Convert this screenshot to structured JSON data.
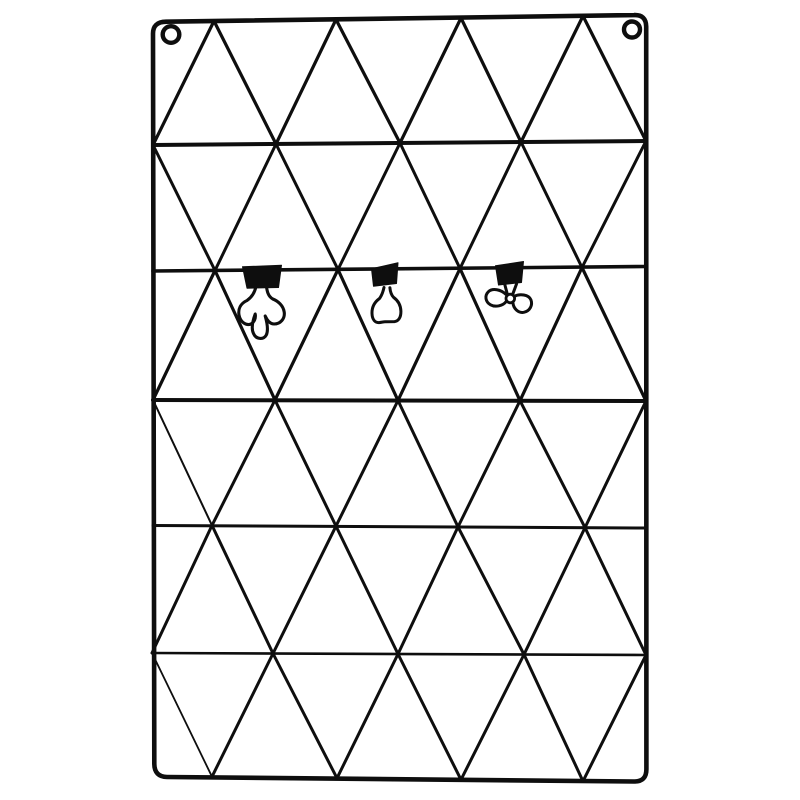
{
  "scene": {
    "description": "Black metal wire wall-mounted memo grid with triangular lattice, two hanging eyelets and three binder clips",
    "background_color": "#ffffff",
    "wire_color": "#0e0e0e"
  },
  "board": {
    "frame": {
      "path": "M 166 21.7 L 634 15.1 Q 646 14.5 646.2 26.5 L 646.4 769 Q 646.5 781.8 634 781.5 L 167 777 Q 154.5 776.8 154.3 764 L 153 34 Q 152.8 21.9 166 21.7 Z",
      "stroke_width": 4.6
    },
    "eyelets": [
      {
        "name": "hanging-eyelet-left",
        "cx": 171,
        "cy": 34.5,
        "r": 8.3,
        "stroke_width": 4.4
      },
      {
        "name": "hanging-eyelet-right",
        "cx": 632,
        "cy": 29.5,
        "r": 8.0,
        "stroke_width": 4.4
      }
    ],
    "horizontal_wires": [
      [
        153,
        145,
        646,
        141,
        4.0
      ],
      [
        153,
        271,
        646,
        266.5,
        3.6
      ],
      [
        153,
        400,
        646,
        401,
        4.0
      ],
      [
        153,
        525.5,
        646,
        528,
        3.0
      ],
      [
        152,
        653,
        646,
        655,
        2.6
      ]
    ],
    "diagonal_wires": [
      [
        153,
        145,
        214,
        21,
        3.2
      ],
      [
        214,
        21,
        276,
        144,
        3.2
      ],
      [
        276,
        144,
        336,
        19.5,
        3.2
      ],
      [
        336,
        19.5,
        400,
        143,
        3.2
      ],
      [
        400,
        143,
        461,
        18,
        3.2
      ],
      [
        461,
        18,
        521,
        142,
        3.2
      ],
      [
        521,
        142,
        583,
        16,
        3.2
      ],
      [
        583,
        16,
        646,
        141,
        3.2
      ],
      [
        153,
        145,
        215,
        270.5,
        3.0
      ],
      [
        215,
        270.5,
        276,
        144,
        3.0
      ],
      [
        276,
        144,
        338,
        269.5,
        3.0
      ],
      [
        338,
        269.5,
        400,
        143,
        3.0
      ],
      [
        400,
        143,
        460,
        268.5,
        3.0
      ],
      [
        460,
        268.5,
        521,
        142,
        3.0
      ],
      [
        521,
        142,
        582,
        267.5,
        3.0
      ],
      [
        582,
        267.5,
        646,
        141,
        3.0
      ],
      [
        153,
        400,
        215,
        270.5,
        3.2
      ],
      [
        215,
        270.5,
        275,
        400,
        3.2
      ],
      [
        275,
        400,
        338,
        269.5,
        3.2
      ],
      [
        338,
        269.5,
        398,
        400.5,
        3.2
      ],
      [
        398,
        400.5,
        460,
        268.5,
        3.2
      ],
      [
        460,
        268.5,
        520,
        400.7,
        3.2
      ],
      [
        520,
        400.7,
        582,
        267.5,
        3.2
      ],
      [
        582,
        267.5,
        646,
        401,
        3.2
      ],
      [
        153,
        400,
        212,
        525.4,
        2.0
      ],
      [
        212,
        525.4,
        275,
        400,
        3.0
      ],
      [
        275,
        400,
        336,
        526.1,
        3.0
      ],
      [
        336,
        526.1,
        398,
        400.5,
        3.0
      ],
      [
        398,
        400.5,
        458,
        526.9,
        3.0
      ],
      [
        458,
        526.9,
        520,
        400.7,
        3.0
      ],
      [
        520,
        400.7,
        585,
        527.6,
        3.0
      ],
      [
        585,
        527.6,
        646,
        401,
        3.0
      ],
      [
        152,
        653,
        212,
        525.4,
        3.0
      ],
      [
        212,
        525.4,
        273,
        653.5,
        3.0
      ],
      [
        273,
        653.5,
        336,
        526.1,
        3.0
      ],
      [
        336,
        526.1,
        398,
        654,
        3.0
      ],
      [
        398,
        654,
        458,
        526.9,
        3.0
      ],
      [
        458,
        526.9,
        524,
        654.5,
        3.0
      ],
      [
        524,
        654.5,
        585,
        527.6,
        3.0
      ],
      [
        585,
        527.6,
        646,
        655,
        3.0
      ],
      [
        152,
        653,
        212,
        776.7,
        1.8
      ],
      [
        212,
        776.7,
        273,
        653.5,
        3.0
      ],
      [
        273,
        653.5,
        337,
        778.2,
        3.0
      ],
      [
        337,
        778.2,
        398,
        654,
        3.0
      ],
      [
        398,
        654,
        461,
        779.7,
        3.0
      ],
      [
        461,
        779.7,
        524,
        654.5,
        3.0
      ],
      [
        524,
        654.5,
        583,
        781.2,
        3.0
      ],
      [
        583,
        781.2,
        646,
        655,
        3.0
      ]
    ],
    "clips": [
      {
        "name": "binder-clip-splayed-handle",
        "body_path": "M242.5,266.8 L281.5,265.2 L278.5,287.5 L247,288.2 Z",
        "wire_paths": [
          "M256,286 C255,292 252,297 247,300.5 C240.5,303.5 238,309 239,315 C240.3,322 246,326 251,324 C254.2,322.4 256,318 255.2,314 C253,320 251,328.5 253.5,333.5 C256,339.5 263.5,340 266.3,335 C268.3,330.8 267.2,323 265.2,316 C267,320 270,324 274,324 C280.3,324 285.2,318.8 284.2,312 C283.2,305.6 278,301 272.8,299 C268,296.3 267,291 266.3,285.6"
        ],
        "knots": [],
        "wire_width": 3.1
      },
      {
        "name": "binder-clip-bell-handle",
        "body_path": "M371.5,268.7 L398,262.8 L396.5,283.5 L373.5,286.2 Z",
        "wire_paths": [
          "M384,287.5 C383,292 382,295 379.5,298.5 C374,302.5 371.8,308 372,313.5 C372.2,319.5 375,322.8 379,322.6 C381.5,322.5 383.5,321.6 385.5,321.8 L394.5,321.6 C398.8,321.2 401,317 400.9,311.2 C400.7,305.2 397.8,300.4 393.6,297.4 C391.2,294.8 390.2,291 389.9,287.7"
        ],
        "knots": [],
        "wire_width": 3.0
      },
      {
        "name": "binder-clip-bowtie-handle",
        "body_path": "M495.5,265.8 L523.5,261.5 L521.5,282.5 L498.5,285 Z",
        "wire_paths": [
          "M504.5,283.5 L507.5,294.8",
          "M516.5,284 L512.5,294.8",
          "M506,294.5 C501,289.5 492.5,287.8 488.3,291.8 C484.3,295.8 485.5,302 490.5,304.8 C495.5,307.6 503,305.8 506.2,301.5",
          "M513.8,296.5 C519.8,293.3 528.8,294.5 530.9,299.8 C533,305.2 529.8,311.2 523.8,312.3 C518.3,313.3 513.5,308.5 513,303.2"
        ],
        "knots": [
          {
            "cx": 510.3,
            "cy": 298.5,
            "r": 4.3,
            "w": 2.8
          }
        ],
        "wire_width": 3.0
      }
    ]
  }
}
